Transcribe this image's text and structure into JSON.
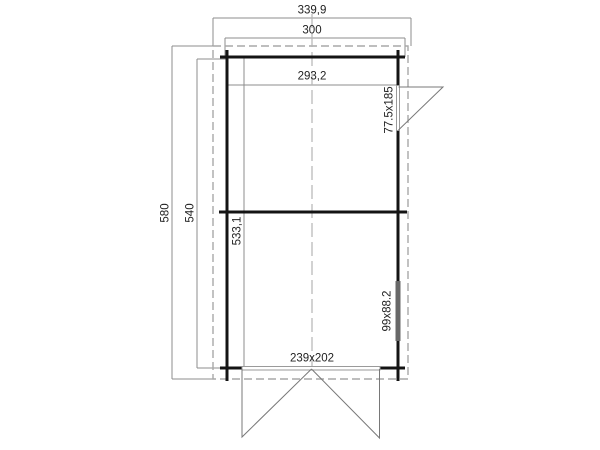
{
  "drawing": {
    "labels": {
      "overall_width": "339,9",
      "wall_width": "300",
      "interior_width": "293,2",
      "overall_depth": "580",
      "wall_depth": "540",
      "interior_depth": "533,1",
      "side_door_size": "77.5x185",
      "window_size": "99x88.2",
      "double_door_size": "239x202"
    },
    "colors": {
      "wall_line": "#141414",
      "dimension_line": "#8c8c8c",
      "dashed_line": "#a8a8a8",
      "swing_line": "#787878",
      "window_fill": "#686868",
      "text": "#222222",
      "background": "#ffffff"
    }
  }
}
